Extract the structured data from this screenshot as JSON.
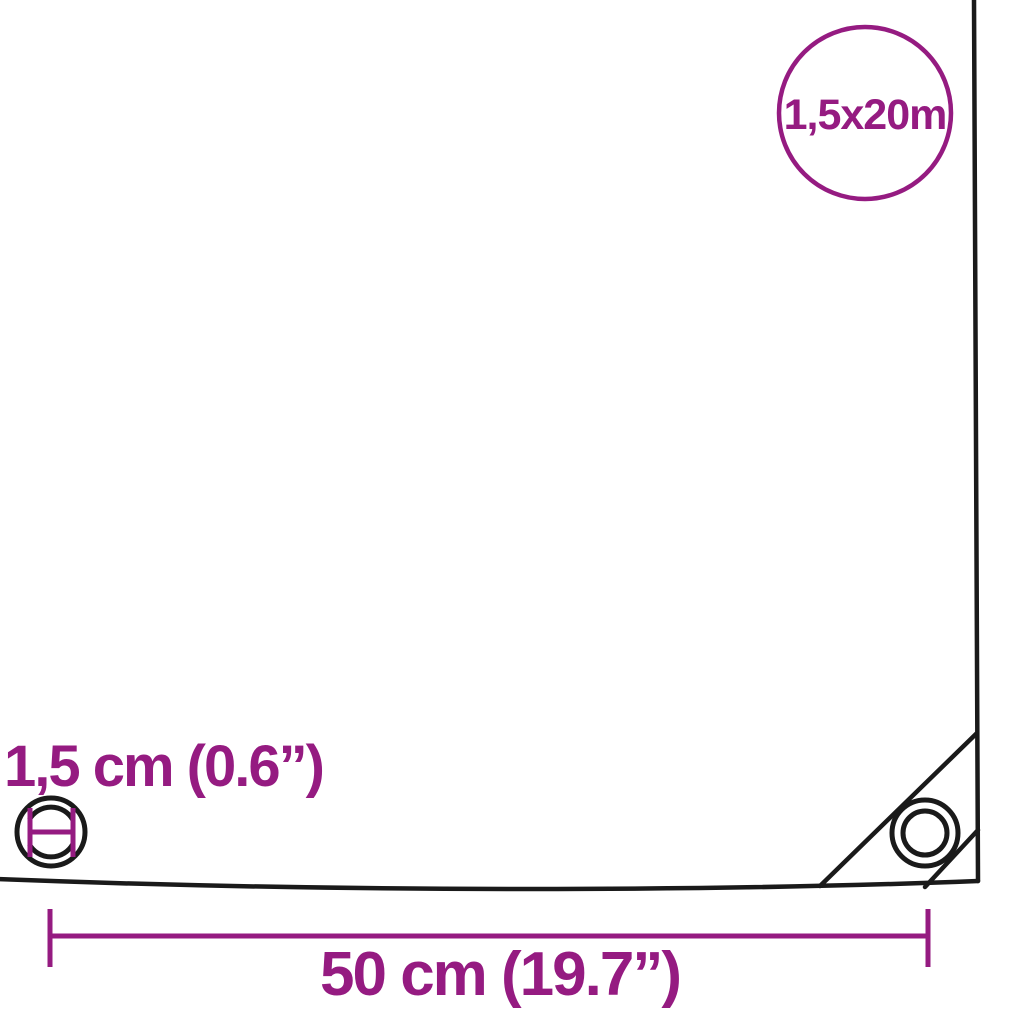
{
  "diagram": {
    "type": "product-dimension-diagram",
    "subject": "tarpaulin corner with eyelets",
    "size_badge_label": "1,5x20m",
    "eyelet_diameter_label": "1,5 cm (0.6”)",
    "edge_width_label": "50 cm (19.7”)"
  },
  "icons": {
    "corner_eyelet": "concentric-circles",
    "eyelet_cross_section": "circle-with-diameter-markers",
    "size_badge": "outlined-circle"
  },
  "colors": {
    "accent_purple": "#951B81",
    "outline_black": "#1A1A1A",
    "background": "#FFFFFF"
  }
}
